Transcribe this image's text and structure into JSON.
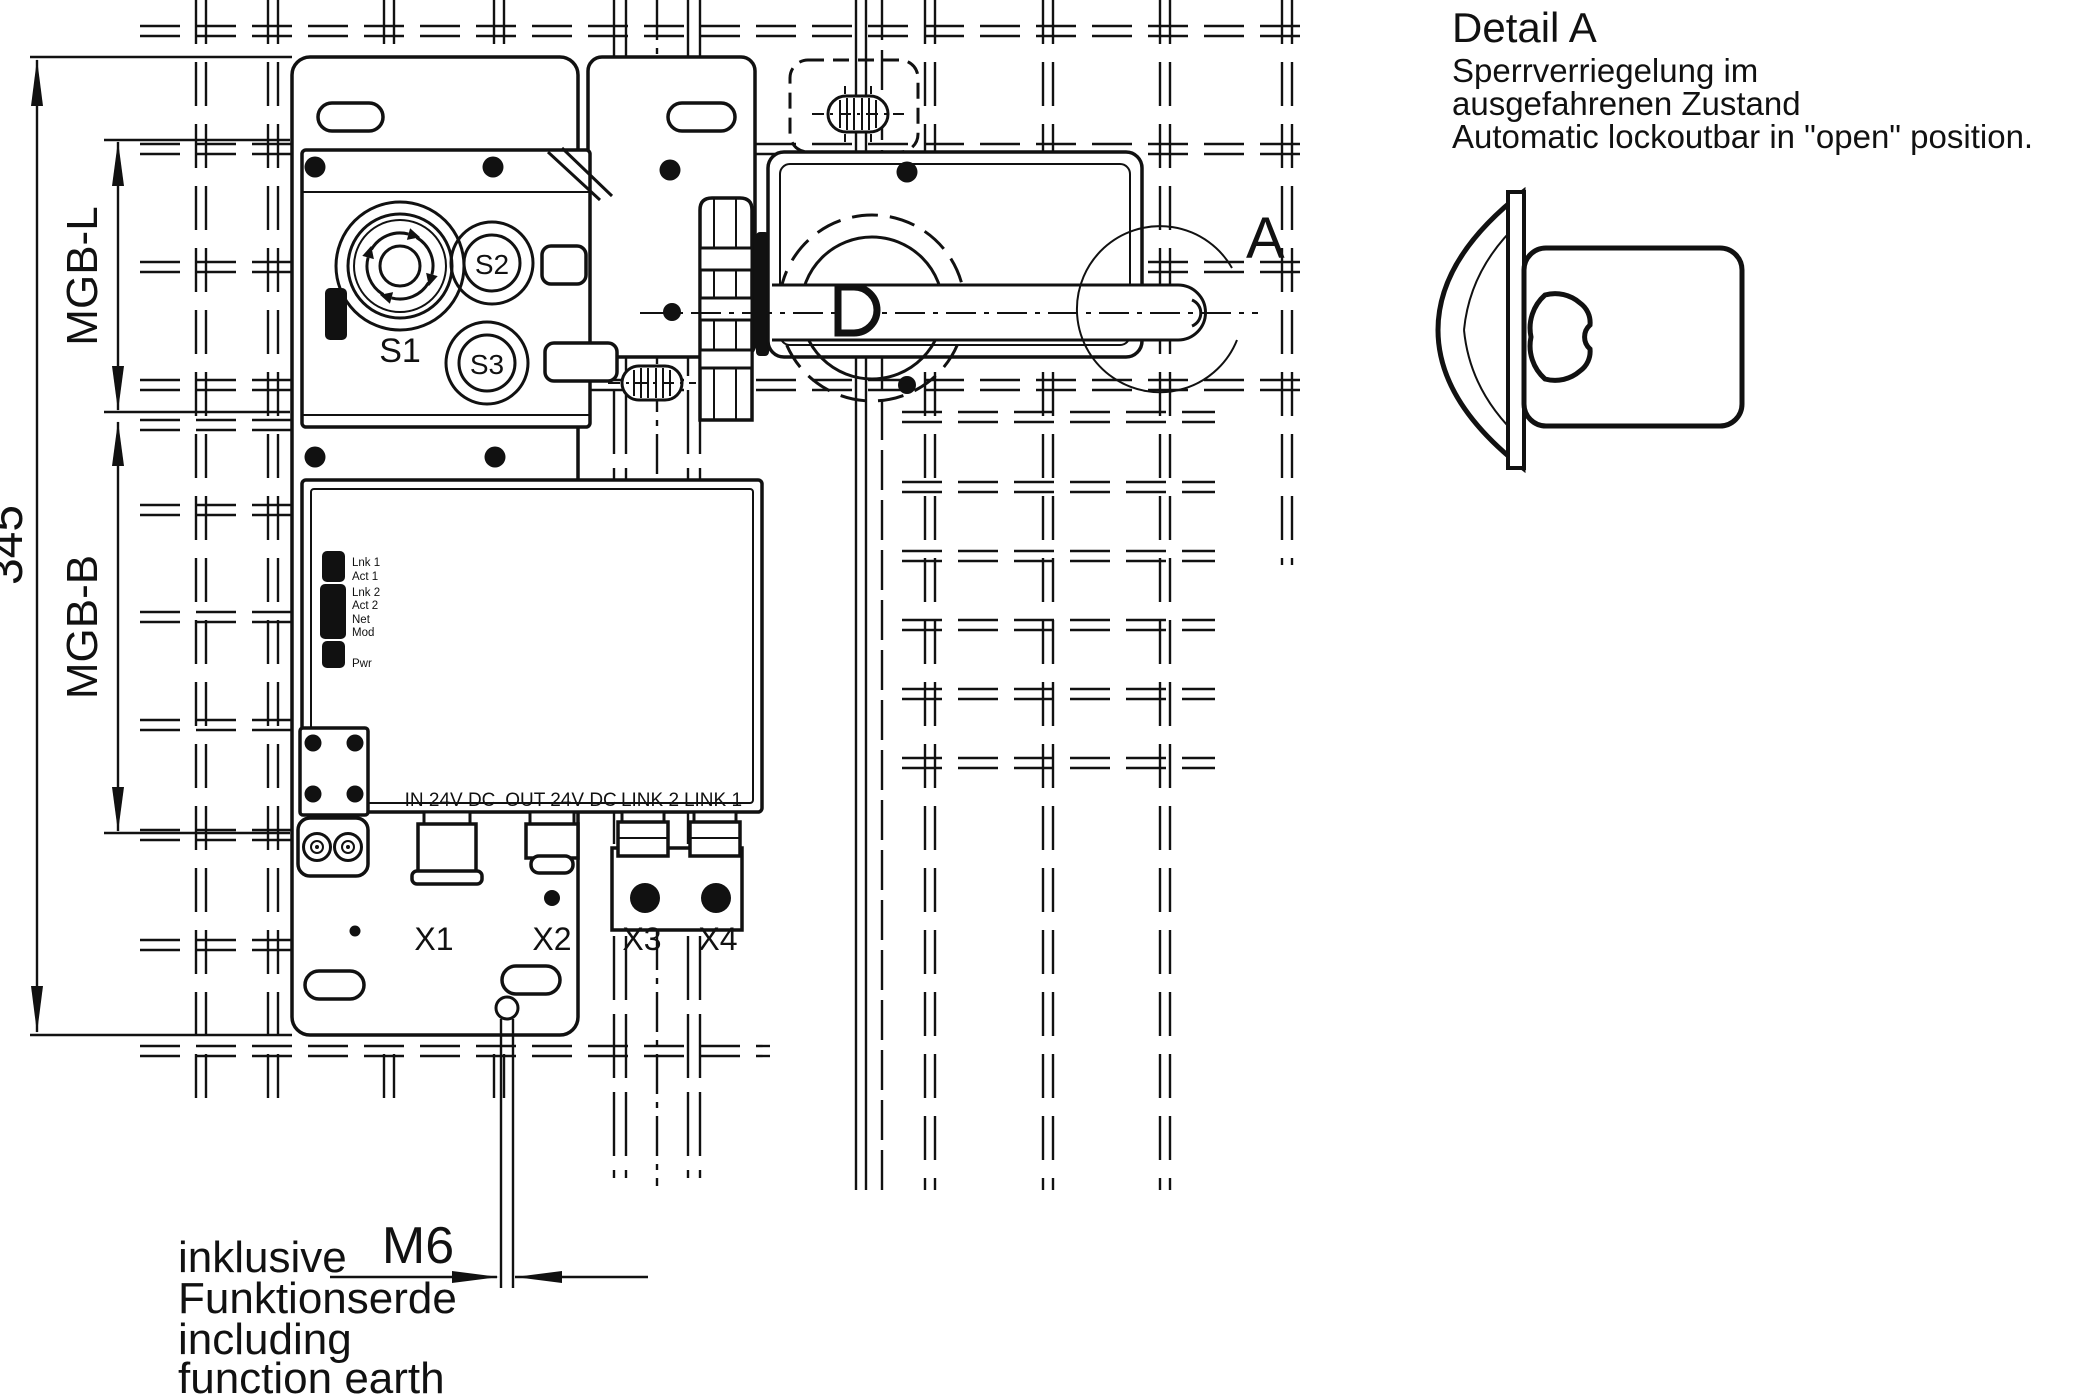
{
  "dimensions": {
    "overall_height": "345",
    "upper_module": "MGB-L",
    "lower_module": "MGB-B",
    "earth_thread": "M6"
  },
  "buttons": {
    "s1": "S1",
    "s2": "S2",
    "s3": "S3"
  },
  "status_leds": [
    "Lnk 1",
    "Act 1",
    "Lnk 2",
    "Act 2",
    "Net",
    "Mod",
    "Pwr"
  ],
  "port_labels": [
    "IN 24V DC",
    "OUT 24V DC",
    "LINK 2",
    "LINK 1"
  ],
  "connectors": [
    "X1",
    "X2",
    "X3",
    "X4"
  ],
  "detail_callout": "A",
  "detail_a": {
    "title": "Detail A",
    "subtitle_de_1": "Sperrverriegelung im",
    "subtitle_de_2": "ausgefahrenen Zustand",
    "subtitle_en": "Automatic lockoutbar in \"open\" position."
  },
  "earth_note": {
    "de_1": "inklusive",
    "de_2": "Funktionserde",
    "en_1": "including",
    "en_2": "function earth"
  }
}
